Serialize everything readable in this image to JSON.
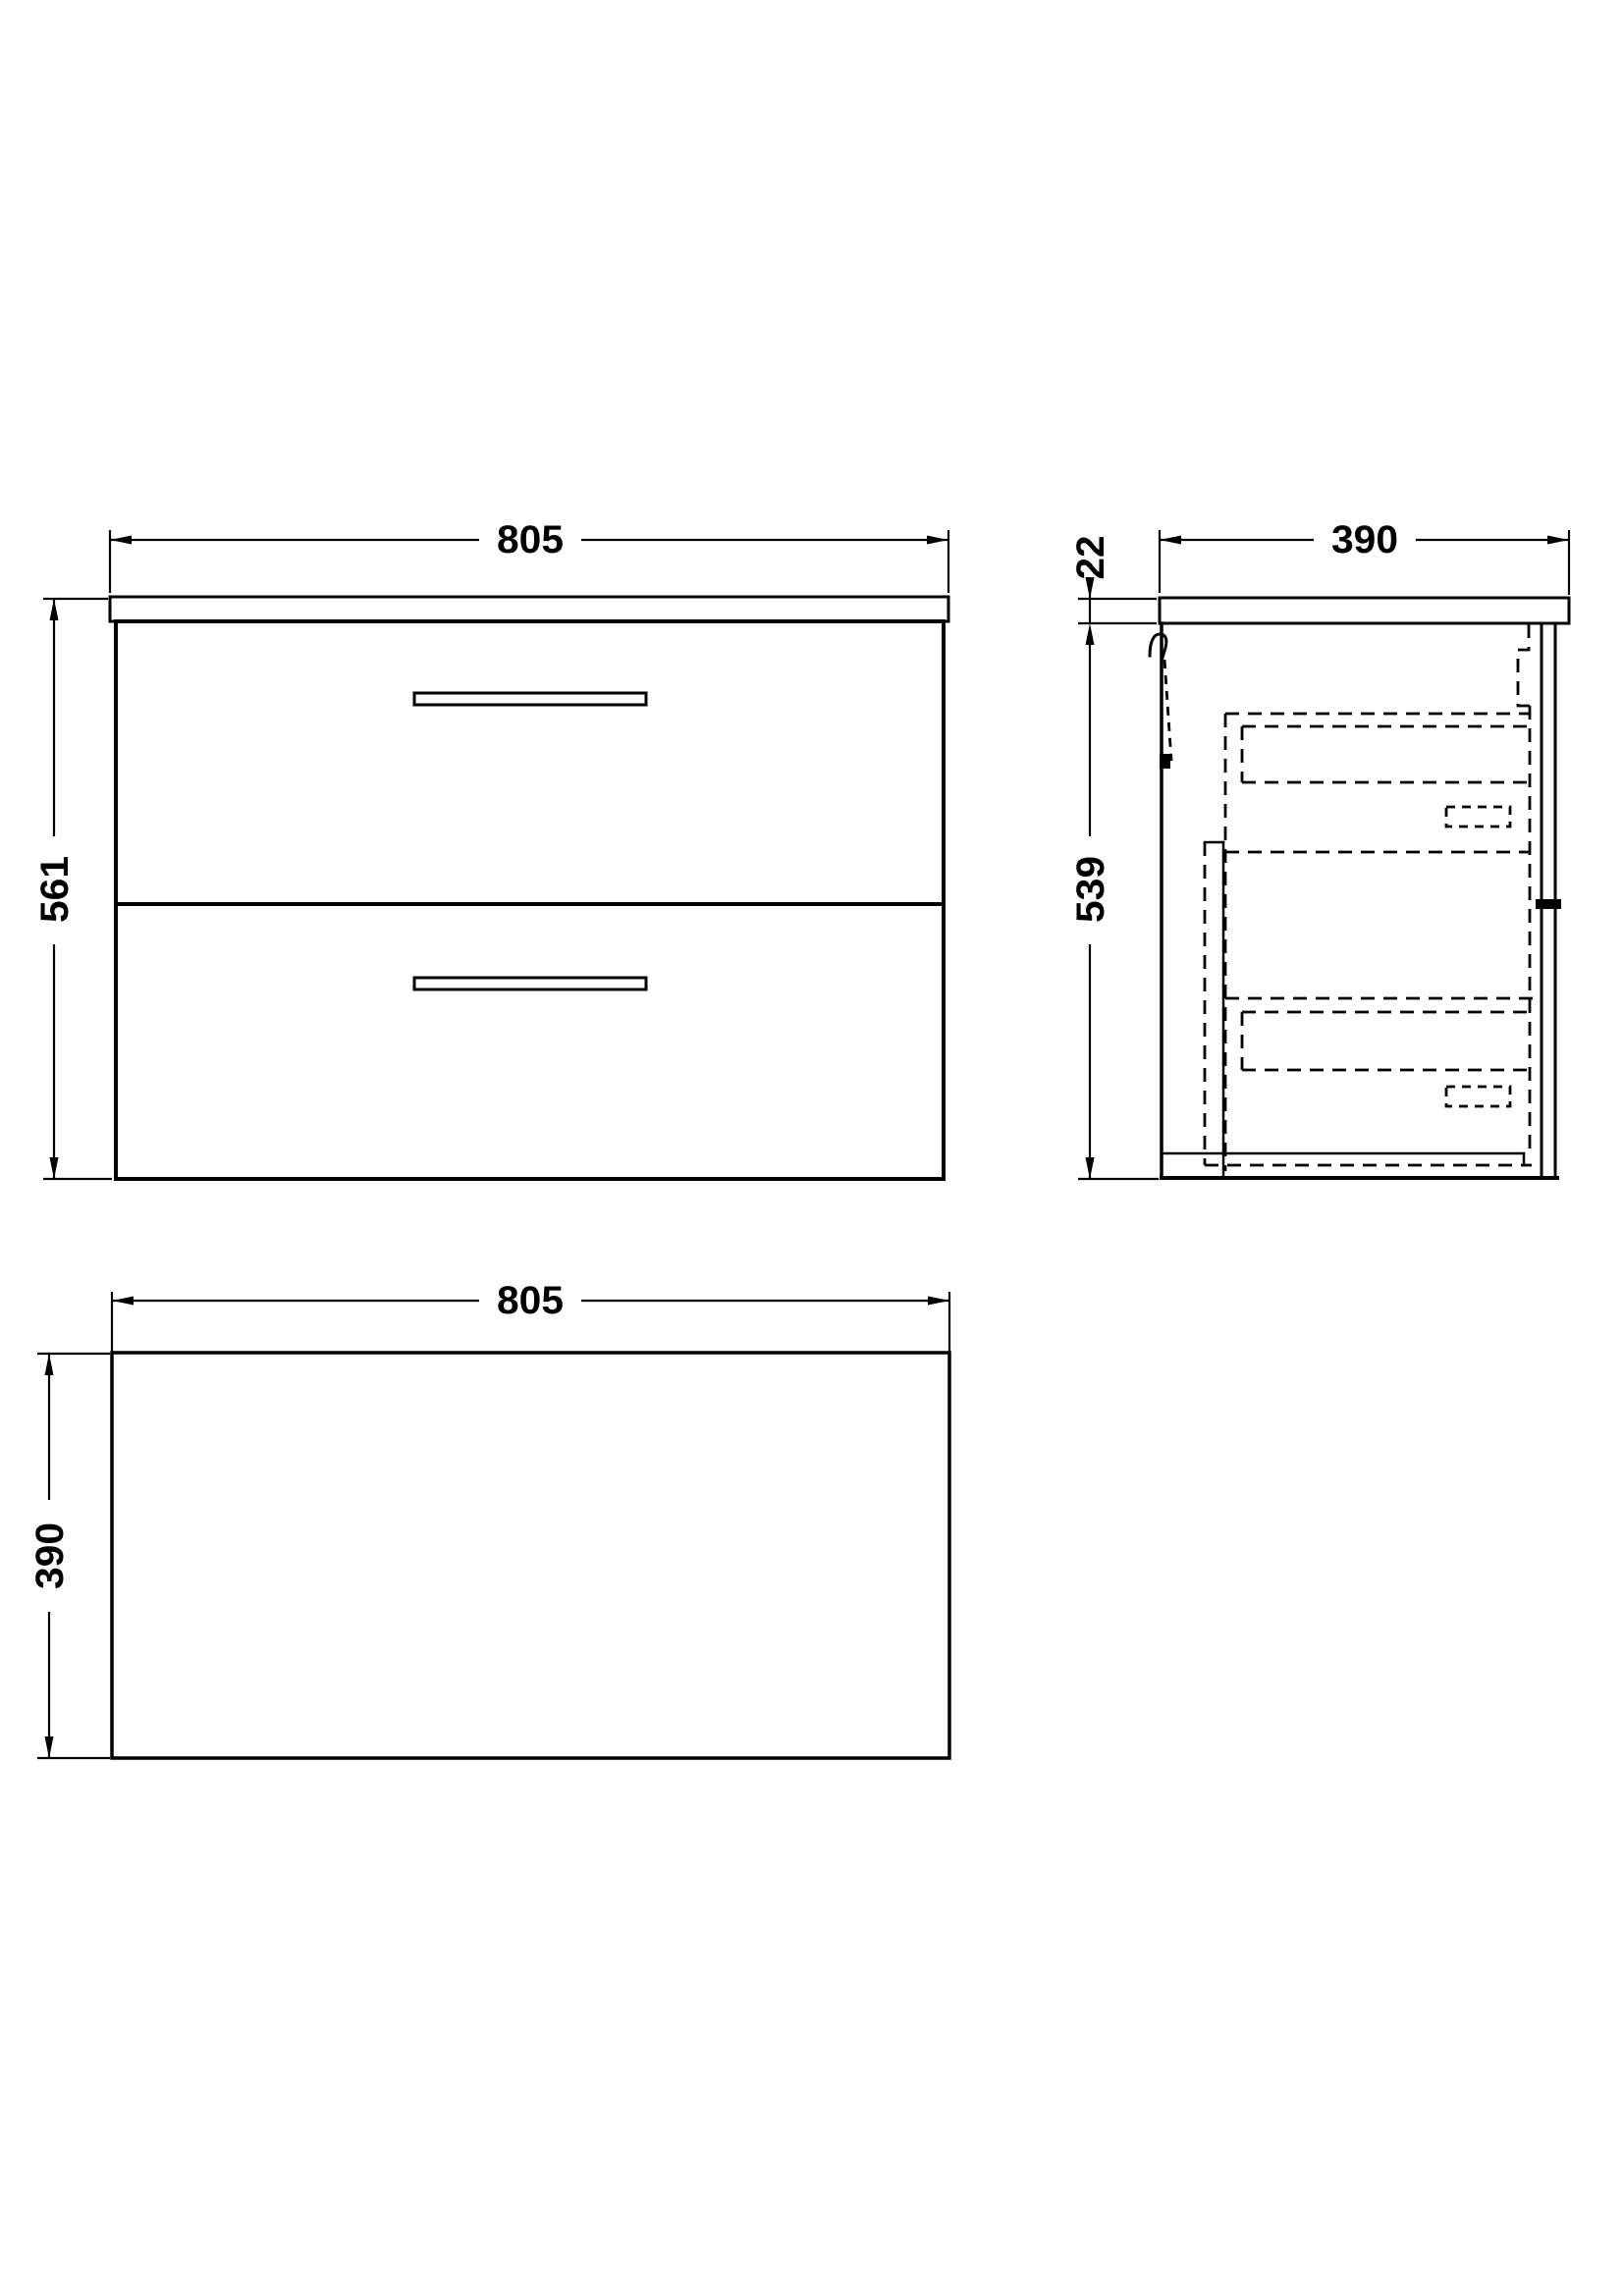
{
  "drawing": {
    "background": "#ffffff",
    "line_color": "#000000",
    "front_view": {
      "width": "805",
      "height": "561"
    },
    "side_view": {
      "depth": "390",
      "worktop_thickness": "22",
      "cabinet_height": "539"
    },
    "plan_view": {
      "width": "805",
      "depth": "390"
    }
  }
}
